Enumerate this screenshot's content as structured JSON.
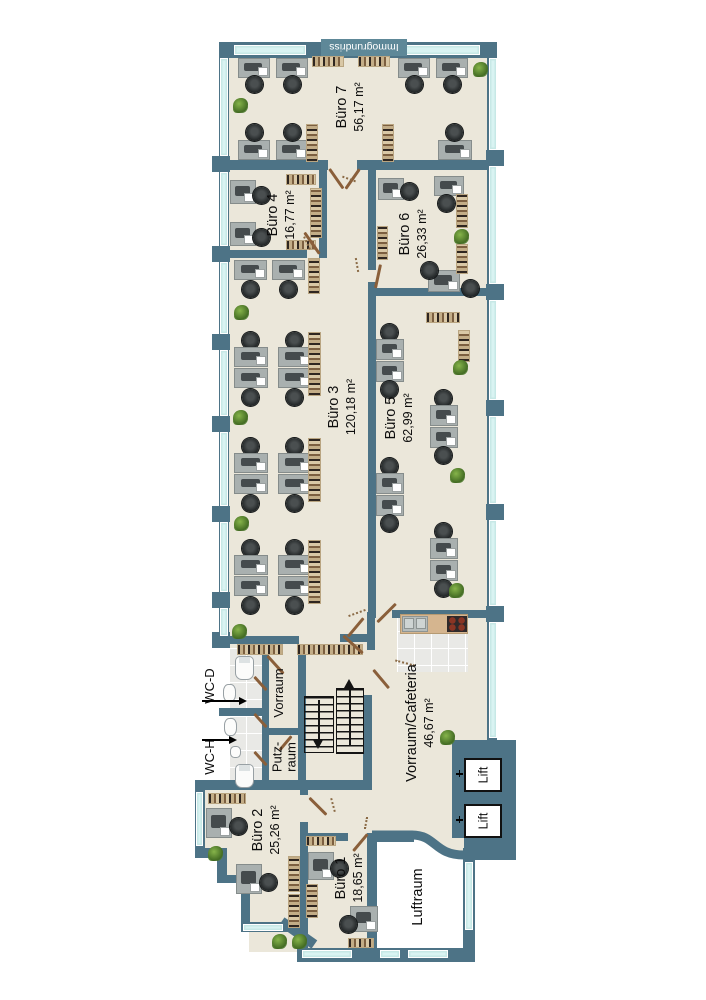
{
  "watermark": {
    "label": "Immogrundriss"
  },
  "rooms": {
    "buero7": {
      "label": "Büro 7",
      "area": "56,17 m²"
    },
    "buero6": {
      "label": "Büro 6",
      "area": "26,33 m²"
    },
    "buero5": {
      "label": "Büro 5",
      "area": "62,99 m²"
    },
    "buero4": {
      "label": "Büro 4",
      "area": "16,77 m²"
    },
    "buero3": {
      "label": "Büro 3",
      "area": "120,18 m²"
    },
    "buero2": {
      "label": "Büro 2",
      "area": "25,26 m²"
    },
    "buero1": {
      "label": "Büro 1",
      "area": "18,65 m²"
    },
    "cafeteria": {
      "label": "Vorraum/Cafeteria",
      "area": "46,67 m²"
    },
    "luftraum": {
      "label": "Luftraum"
    },
    "vorraum": {
      "label": "Vorraum"
    },
    "putzraum": {
      "line1": "Putz-",
      "line2": "raum"
    },
    "wc_d": {
      "label": "WC-D"
    },
    "wc_h": {
      "label": "WC-H"
    },
    "lift": {
      "label": "Lift"
    }
  },
  "colors": {
    "wall": "#4d7386",
    "floor": "#ebe7da",
    "window": "#d9f3f2",
    "door": "#8a5f3a",
    "watermark_bg": "#5e8898"
  }
}
